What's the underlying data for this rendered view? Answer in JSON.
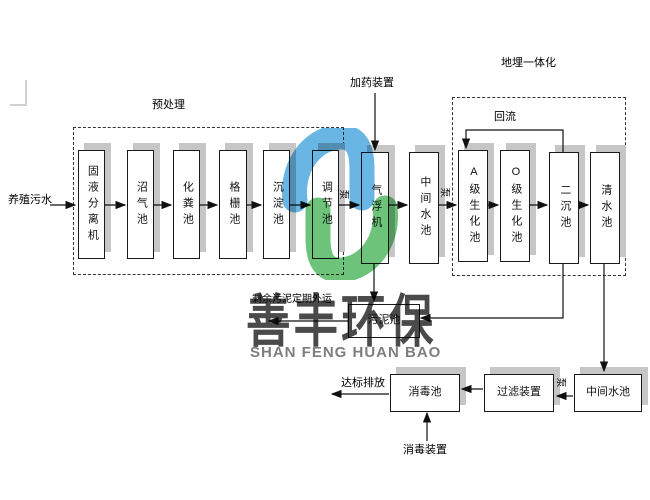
{
  "sections": {
    "pretreatment_label": "预处理",
    "buried_label": "地埋一体化"
  },
  "boxes": {
    "solid_liquid_separator": "固液分离机",
    "biogas_pool": "沼气池",
    "septic_pool": "化粪池",
    "grid_pool": "格栅池",
    "sedimentation_pool": "沉淀池",
    "regulating_pool": "调节池",
    "air_flotation": "气浮机",
    "intermediate_pool_1": "中间水池",
    "a_bio_pool": "A级生化池",
    "o_bio_pool": "O级生化池",
    "secondary_sedimentation_pool": "二沉池",
    "clear_water_pool": "清水池",
    "sludge_pool": "污泥池",
    "disinfection_pool": "消毒池",
    "filter_device": "过滤装置",
    "intermediate_pool_2": "中间水池"
  },
  "labels": {
    "influent": "养殖污水",
    "dosing_device": "加药装置",
    "reflux": "回流",
    "pump": "泵",
    "sludge_out": "剩余污泥定期外运",
    "discharge": "达标排放",
    "disinfection_device": "消毒装置"
  },
  "watermark": {
    "cn": "善丰环保",
    "en": "SHAN FENG HUAN BAO",
    "blue": "#4fa8de",
    "green": "#55b964",
    "cn_color": "#4a4a4a",
    "en_color": "#7e7e7e"
  }
}
